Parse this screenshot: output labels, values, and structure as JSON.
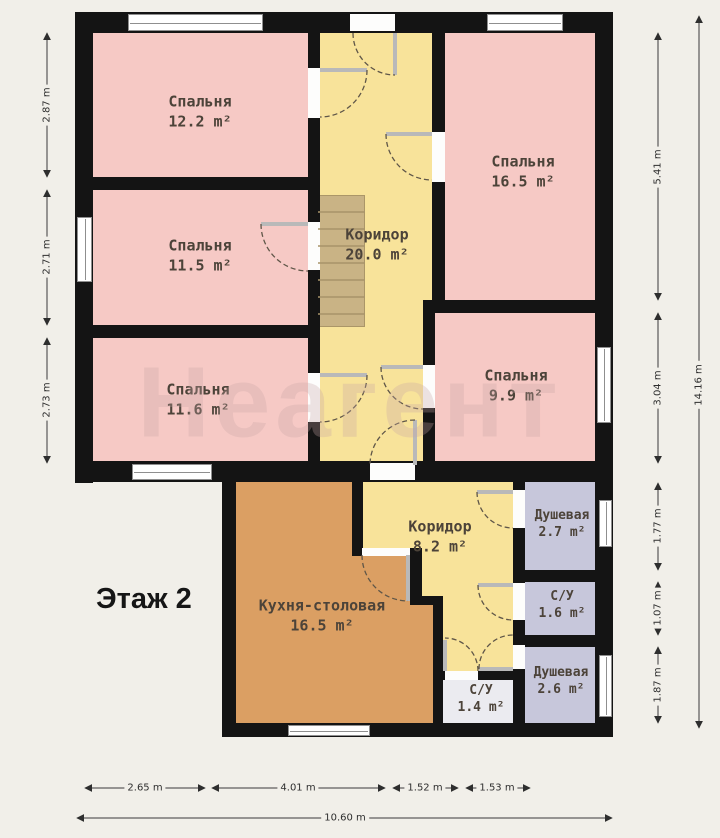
{
  "floor_label": "Этаж 2",
  "watermark": "Неагент",
  "rooms": {
    "bedroom1": {
      "name": "Спальня",
      "area": "12.2 m²"
    },
    "bedroom2": {
      "name": "Спальня",
      "area": "11.5 m²"
    },
    "bedroom3": {
      "name": "Спальня",
      "area": "11.6 m²"
    },
    "bedroom4": {
      "name": "Спальня",
      "area": "16.5 m²"
    },
    "bedroom5": {
      "name": "Спальня",
      "area": "9.9 m²"
    },
    "hall_upper": {
      "name": "Коридор",
      "area": "20.0 m²"
    },
    "hall_lower": {
      "name": "Коридор",
      "area": "8.2 m²"
    },
    "kitchen": {
      "name": "Кухня-столовая",
      "area": "16.5 m²"
    },
    "shower1": {
      "name": "Душевая",
      "area": "2.7 m²"
    },
    "wc1": {
      "name": "С/У",
      "area": "1.6 m²"
    },
    "shower2": {
      "name": "Душевая",
      "area": "2.6 m²"
    },
    "wc2": {
      "name": "С/У",
      "area": "1.4 m²"
    }
  },
  "dimensions": {
    "left": [
      "2.87 m",
      "2.71 m",
      "2.73 m"
    ],
    "right": [
      "5.41 m",
      "3.04 m",
      "1.77 m",
      "1.07 m",
      "1.87 m"
    ],
    "right_total": "14.16 m",
    "bottom": [
      "2.65 m",
      "4.01 m",
      "1.52 m",
      "1.53 m"
    ],
    "bottom_total": "10.60 m"
  },
  "colors": {
    "background": "#f1efe9",
    "wall": "#141414",
    "bedroom": "#f6c9c5",
    "corridor": "#f8e39a",
    "kitchen": "#db9f63",
    "bathroom": "#c7c7db",
    "wc_small": "#ebebf0",
    "stairs": "#c9b385"
  }
}
